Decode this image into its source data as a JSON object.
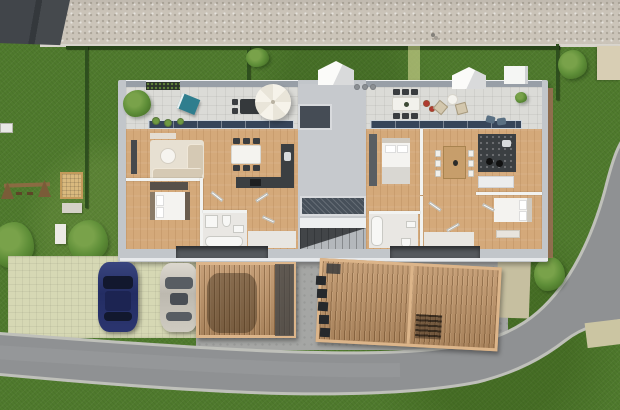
{
  "scene": {
    "description": "Top-down 3D architectural render of a duplex house plot",
    "view": "bird's-eye cut-away floor plan",
    "site": {
      "neighbor_roof": "dark gabled roof, top-left corner",
      "sidewalk": "gravel path along the top edge",
      "road": "asphalt road running along the bottom and curving up the right side",
      "lawn": "green grass surrounding the plot",
      "hedges": [
        "top boundary hedge",
        "left boundary hedge",
        "right boundary hedge"
      ],
      "garden": {
        "playground": [
          "wooden swing set",
          "sandbox",
          "paved pad"
        ],
        "vegetation": [
          "corner shrubs",
          "garden tree",
          "roadside tree",
          "small bushes"
        ]
      },
      "parking": {
        "open_parking_spaces": 2,
        "cars": [
          {
            "name": "blue car",
            "color": "#2a3470"
          },
          {
            "name": "silver car",
            "color": "#c8c4ba"
          }
        ],
        "carports": [
          {
            "name": "single carport",
            "roof": "wood slats",
            "contains": "parked car silhouette"
          },
          {
            "name": "double carport",
            "roof": "wood slats",
            "contains": "slatted furniture"
          }
        ],
        "bins_row_count": 5
      }
    },
    "building": {
      "type": "semi-detached flat-roof duplex",
      "shared_elements": [
        "central stairwell",
        "roof skylight",
        "hatched light well",
        "three roof dormers"
      ],
      "units": [
        {
          "name": "left unit",
          "rooms": [
            "living room",
            "dining area",
            "kitchen",
            "bedroom",
            "bathroom",
            "hallway",
            "entrance porch"
          ],
          "terrace_items": [
            "hedge planter",
            "teal lounger",
            "dark dining set",
            "white parasol",
            "potted plants"
          ]
        },
        {
          "name": "right unit",
          "rooms": [
            "bedroom",
            "dining area",
            "kitchen",
            "second bedroom",
            "bathroom",
            "hallway",
            "entrance porch"
          ],
          "terrace_items": [
            "white dining set with six chairs",
            "red potted flowers",
            "two wicker chairs",
            "round side table",
            "green plant",
            "blue loungers"
          ]
        }
      ]
    },
    "palette": {
      "grass": "#4f7a2d",
      "gravel_sidewalk": "#cbc4b9",
      "asphalt": "#8f9193",
      "curb": "#bfc0ba",
      "neighbor_roof": "#41454a",
      "concrete_drive": "#a5a6a4",
      "grass_pavers": "#d6d8b4",
      "carport_wood": "#bf9468",
      "roof_edge": "#c2c6ca",
      "terrace_tile": "#dbdbd7",
      "parapet": "#989fa7",
      "glass": "#36455a",
      "wood_floor": "#d4a97a",
      "kitchen_dark": "#3b3f42",
      "furniture_white": "#f4f3f0",
      "sofa_beige": "#d5c9b4",
      "lounger_teal": "#2f7e8e",
      "parasol": "#f4f1e8",
      "car_blue": "#2a3470",
      "car_silver": "#c8c4ba"
    }
  }
}
